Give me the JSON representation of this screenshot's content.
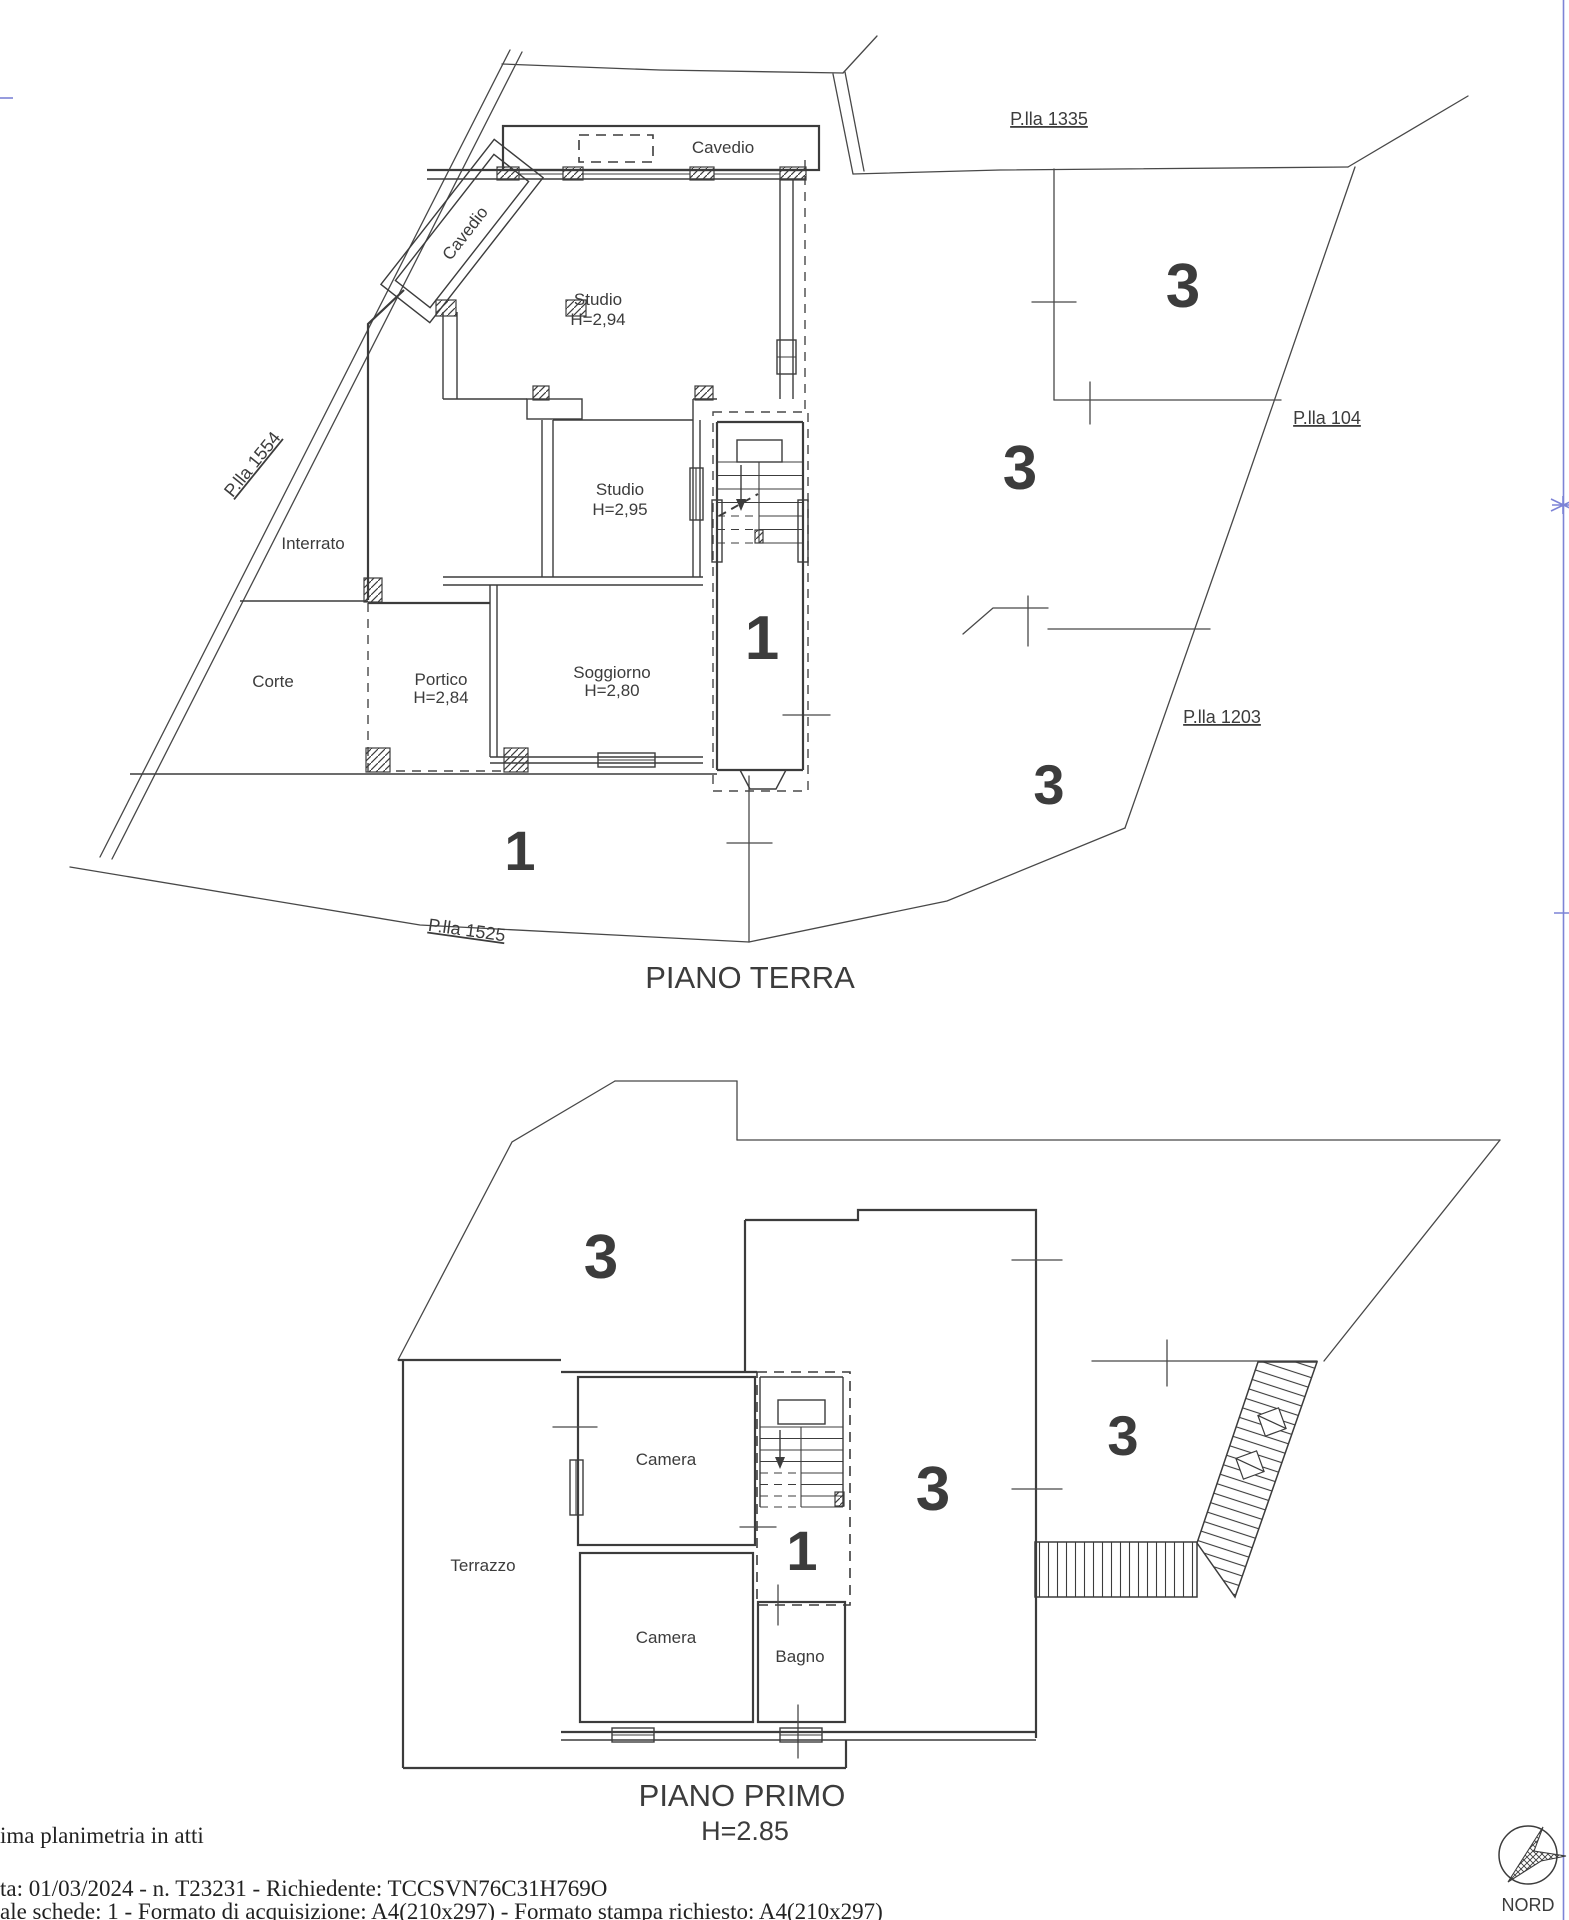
{
  "sheet": {
    "ground_floor": {
      "title": "PIANO TERRA",
      "labels": {
        "cavedio_top": "Cavedio",
        "cavedio_shaft": "Cavedio",
        "studio_a": "Studio",
        "studio_a_h": "H=2,94",
        "studio_b": "Studio",
        "studio_b_h": "H=2,95",
        "interrato": "Interrato",
        "corte": "Corte",
        "portico": "Portico",
        "portico_h": "H=2,84",
        "soggiorno": "Soggiorno",
        "soggiorno_h": "H=2,80"
      },
      "parcels": {
        "p1335": "P.lla 1335",
        "p104": "P.lla 104",
        "p1203": "P.lla 1203",
        "p1525": "P.lla 1525",
        "p1554": "P.lla 1554"
      },
      "subaltern_numbers": {
        "stair": "1",
        "court": "1",
        "area_ne": "3",
        "area_e": "3",
        "area_se": "3"
      }
    },
    "first_floor": {
      "title": "PIANO PRIMO",
      "height_note": "H=2.85",
      "labels": {
        "camera_a": "Camera",
        "camera_b": "Camera",
        "bagno": "Bagno",
        "terrazzo": "Terrazzo"
      },
      "subaltern_numbers": {
        "stair": "1",
        "area_nw": "3",
        "area_main": "3",
        "area_e": "3"
      }
    },
    "compass": {
      "label": "NORD"
    },
    "footer": {
      "line1": "ima planimetria in atti",
      "line2": "ta: 01/03/2024 - n. T23231 - Richiedente: TCCSVN76C31H769O",
      "line3": "ale schede: 1 - Formato di acquisizione: A4(210x297)  - Formato stampa richiesto: A4(210x297)"
    },
    "colors": {
      "line": "#3c3c3c",
      "frame_blue": "#7d83d6"
    }
  }
}
